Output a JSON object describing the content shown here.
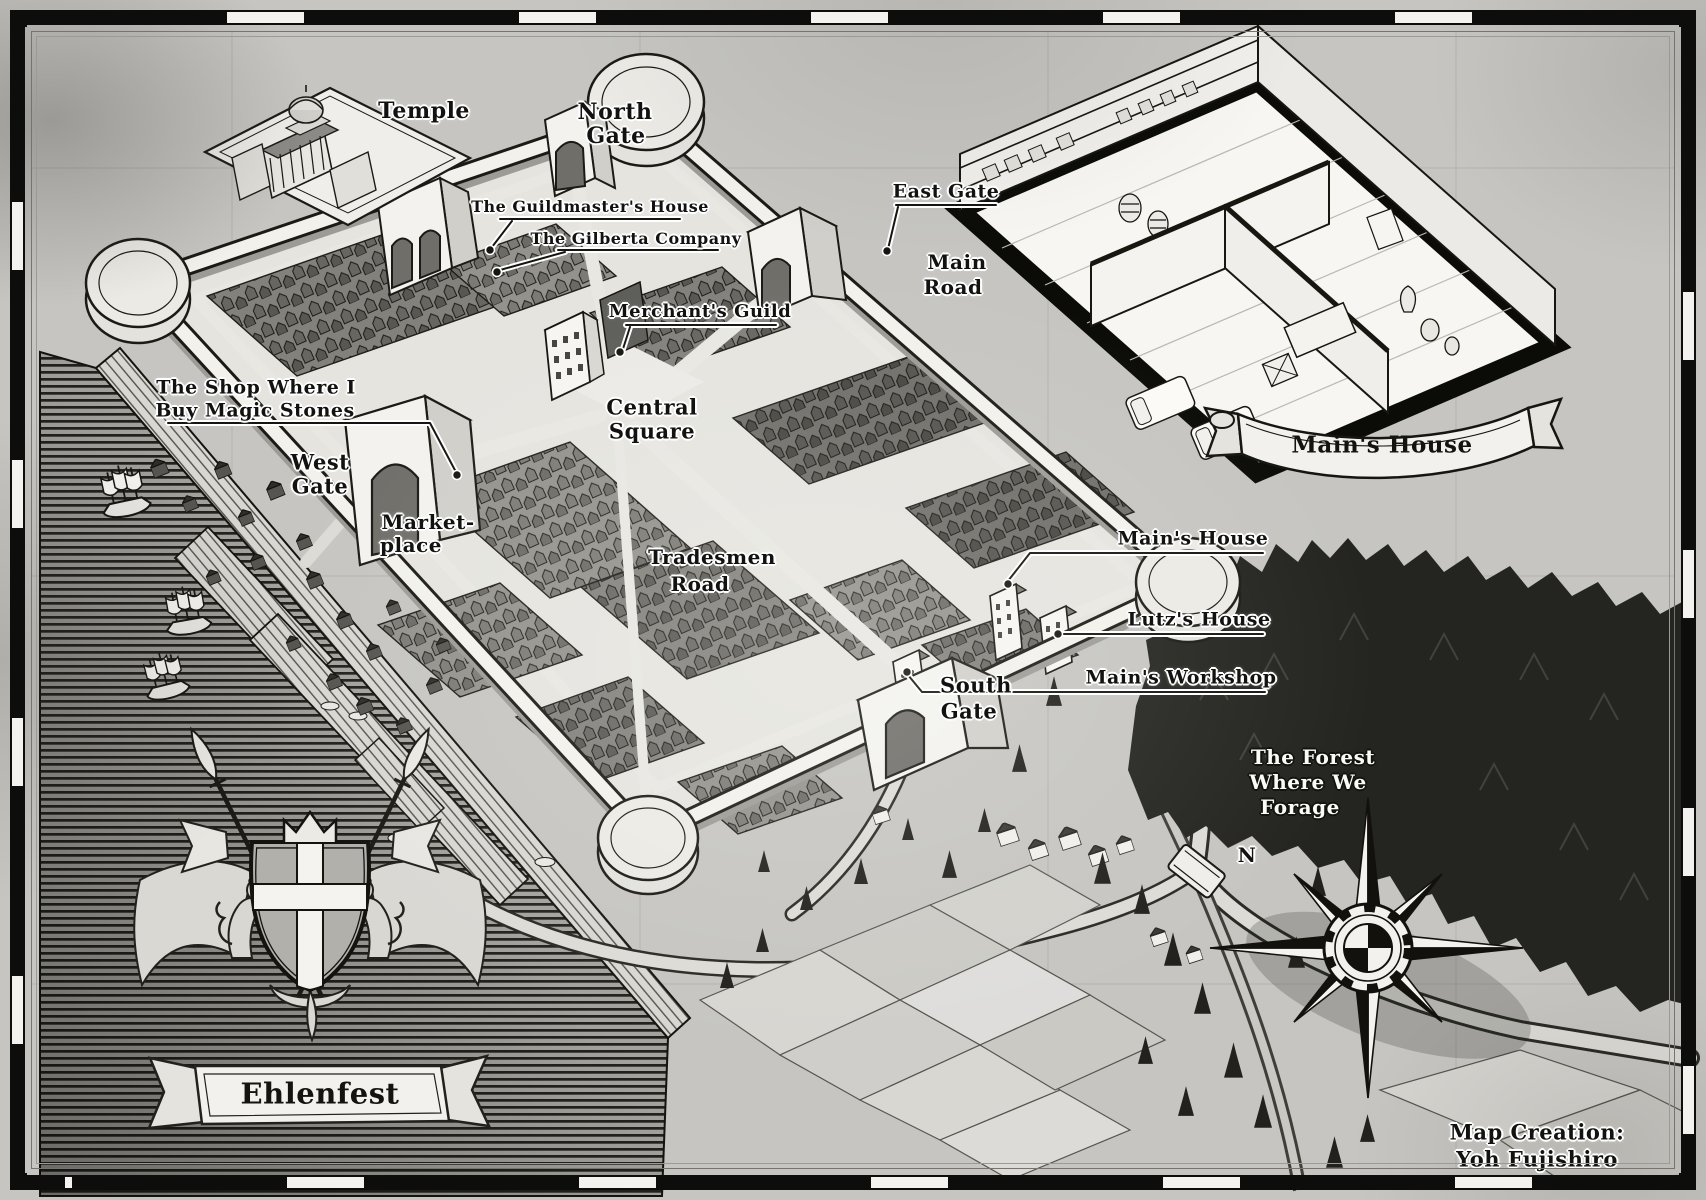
{
  "map_title": "Ehlenfest fantasy city map",
  "labels": {
    "temple": "Temple",
    "north_gate_1": "North",
    "north_gate_2": "Gate",
    "guildmasters_house": "The Guildmaster's House",
    "gilberta_company": "The Gilberta Company",
    "east_gate": "East Gate",
    "main_road_1": "Main",
    "main_road_2": "Road",
    "merchants_guild": "Merchant's Guild",
    "central_square_1": "Central",
    "central_square_2": "Square",
    "magic_stones_1": "The Shop Where I",
    "magic_stones_2": "Buy Magic Stones",
    "west_gate_1": "West",
    "west_gate_2": "Gate",
    "marketplace_1": "Market-",
    "marketplace_2": "place",
    "tradesmen_road_1": "Tradesmen",
    "tradesmen_road_2": "Road",
    "mains_house": "Main's House",
    "lutzs_house": "Lutz's House",
    "mains_workshop": "Main's Workshop",
    "south_gate_1": "South",
    "south_gate_2": "Gate",
    "forest_1": "The Forest",
    "forest_2": "Where We",
    "forest_3": "Forage"
  },
  "banners": {
    "city_name": "Ehlenfest",
    "inset_title": "Main's House"
  },
  "credit": {
    "line1": "Map Creation:",
    "line2": "Yoh Fujishiro"
  },
  "compass": {
    "north": "N"
  },
  "colors": {
    "paper": "#c6c5c1",
    "ink": "#14140f",
    "forest": "#242420",
    "water_line": "#21211d"
  }
}
